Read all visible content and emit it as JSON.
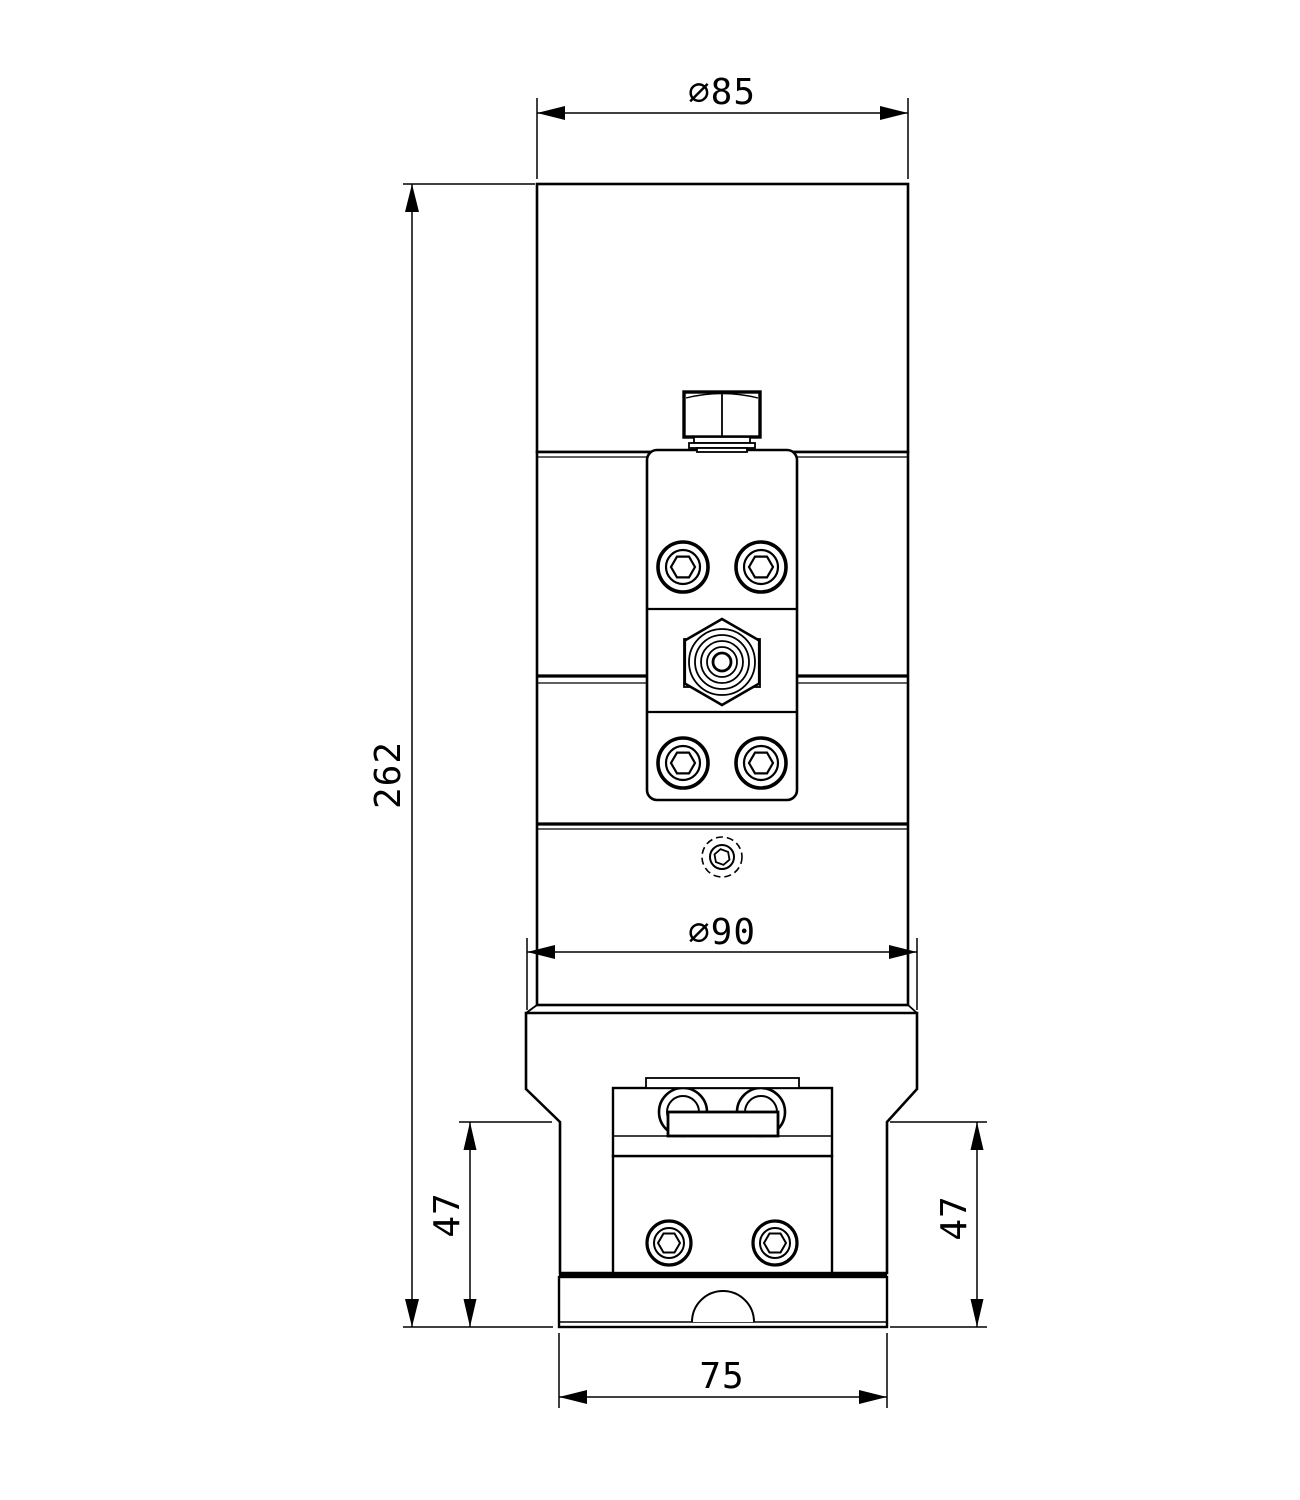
{
  "drawing": {
    "background_color": "#ffffff",
    "line_color": "#000000",
    "view": "front-view-dimension-drawing",
    "dimensions": {
      "top_diameter": {
        "label": "∅85",
        "value": 85
      },
      "flange_diameter": {
        "label": "∅90",
        "value": 90
      },
      "overall_height": {
        "label": "262",
        "value": 262
      },
      "bracket_height_left": {
        "label": "47",
        "value": 47
      },
      "bracket_height_right": {
        "label": "47",
        "value": 47
      },
      "base_width": {
        "label": "75",
        "value": 75
      }
    }
  }
}
